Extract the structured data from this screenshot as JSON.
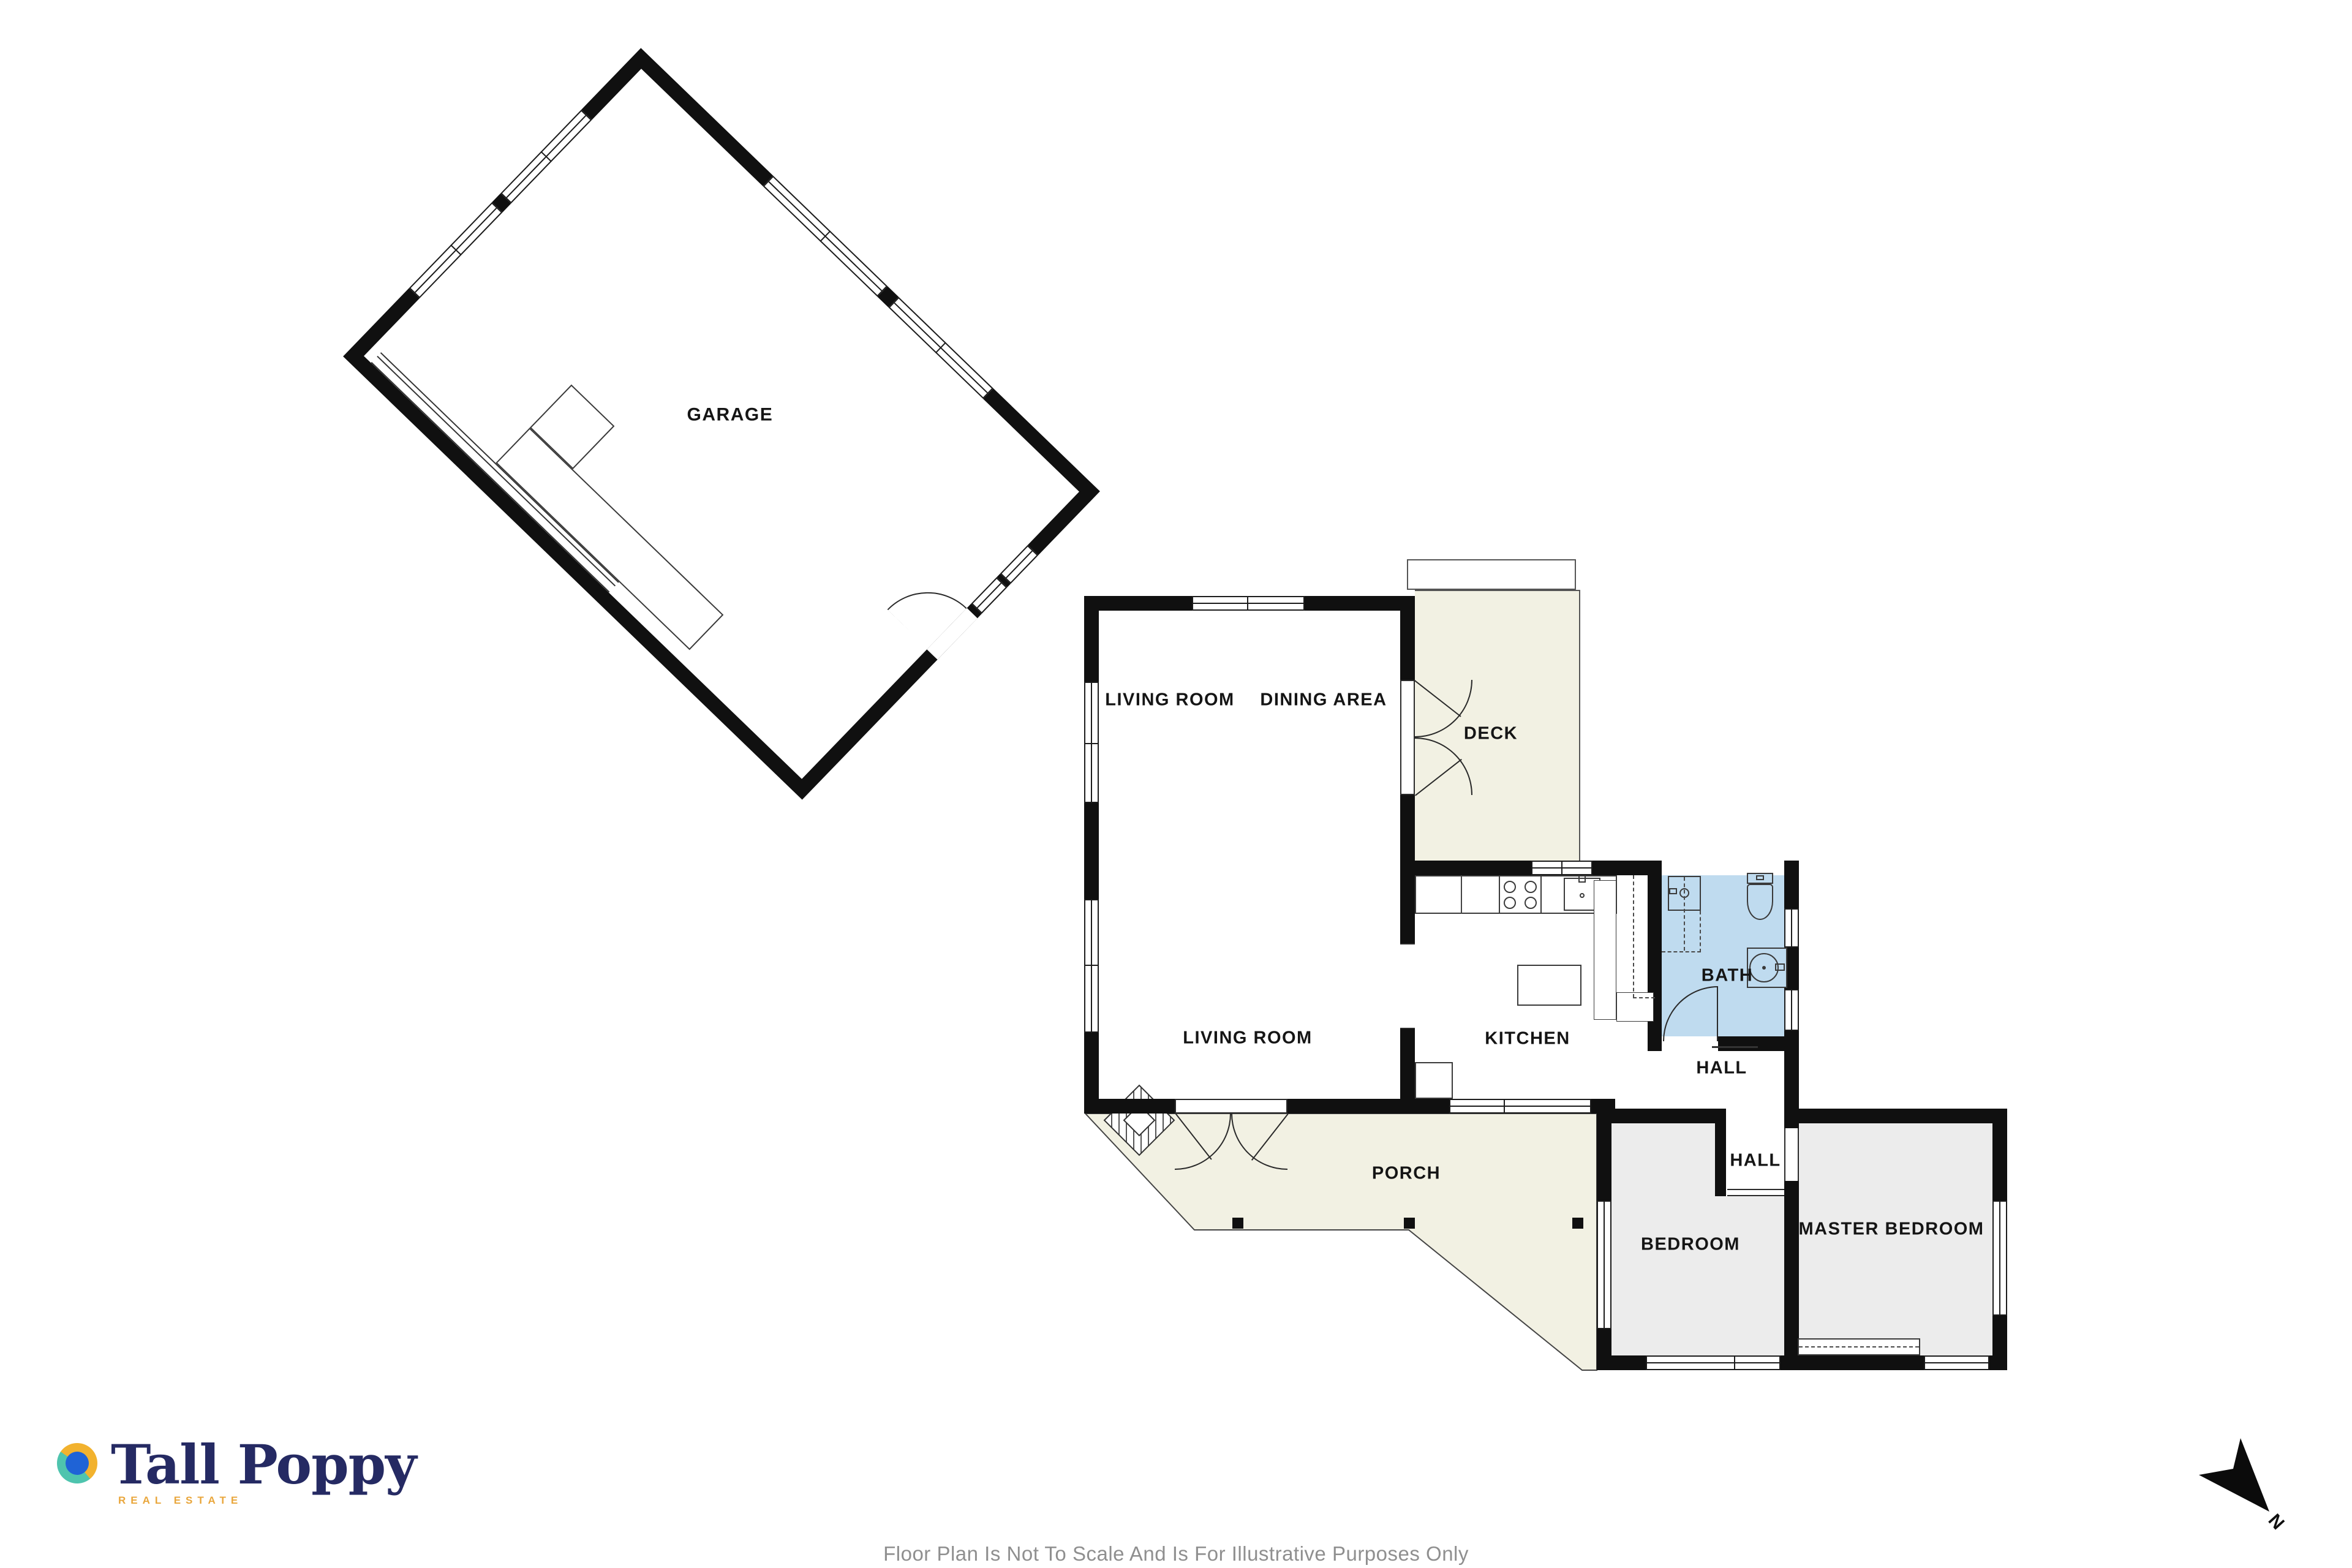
{
  "rooms": {
    "garage": "GARAGE",
    "living1": "LIVING ROOM",
    "dining": "DINING AREA",
    "deck": "DECK",
    "living2": "LIVING ROOM",
    "kitchen": "KITCHEN",
    "bath": "BATH",
    "hall_upper": "HALL",
    "hall_lower": "HALL",
    "porch": "PORCH",
    "bedroom": "BEDROOM",
    "master": "MASTER BEDROOM"
  },
  "logo": {
    "brand": "Tall Poppy",
    "tagline": "REAL ESTATE"
  },
  "compass": {
    "north_label": "N"
  },
  "footer": {
    "disclaimer": "Floor Plan Is Not To Scale And Is For Illustrative Purposes Only"
  },
  "colors": {
    "wall": "#101010",
    "deck_porch_fill": "#F2F1E3",
    "bath_fill": "#BFDBEF",
    "bedroom_fill": "#ECECEC",
    "brand_navy": "#252A63",
    "brand_gold": "#E9A63B",
    "brand_teal": "#4EC4AE",
    "brand_blue": "#1F63D6",
    "disclaimer_gray": "#8F8F8F"
  }
}
